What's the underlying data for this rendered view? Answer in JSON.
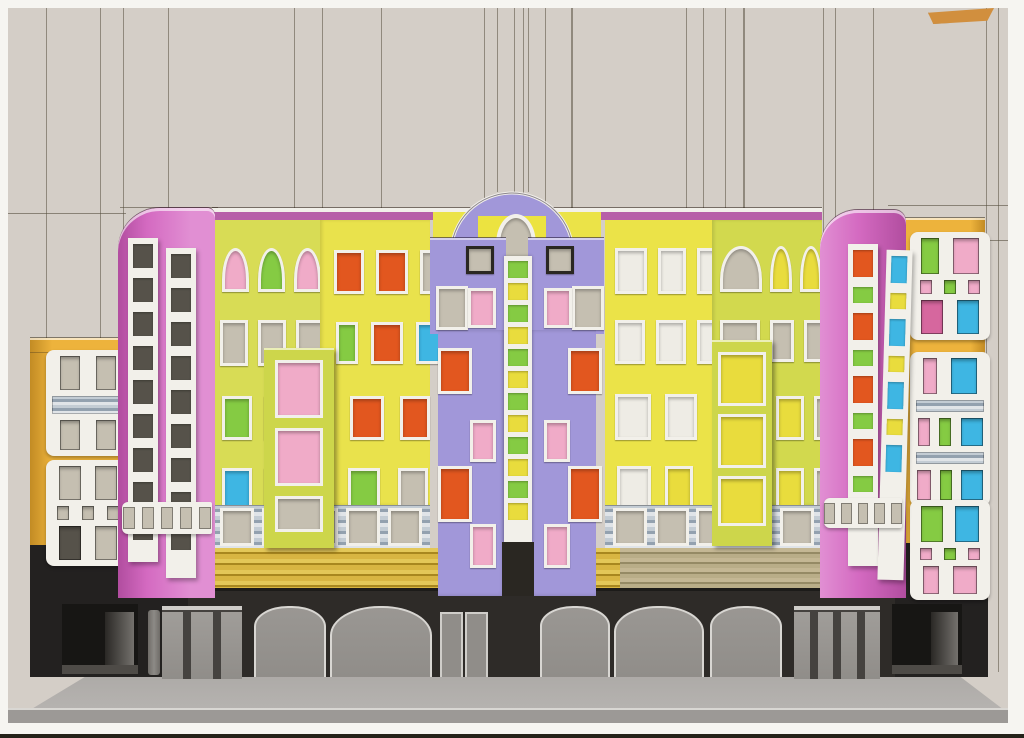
{
  "palette": {
    "cardboard": "#d4cec7",
    "bgline": "#57503f",
    "printWhite": "#f6f5f1",
    "printDark": "#242219",
    "street": "#adaaa7",
    "streetFace": "#9c9996",
    "streetHl": "#d9d7d3",
    "ground": "#2e2b28",
    "groundLip": "#1c1b19",
    "doorGray": "#908d89",
    "doorDark": "#45423f",
    "interior": "#171614",
    "interiorWall": "#74716d",
    "pillar": "#8d8a86",
    "lintel": "#cfcdc9",
    "orangeWing": "#edb33c",
    "wingShade": "#c28b24",
    "wingBase": "#232120",
    "whiteFrame": "#f2f0ea",
    "darkFrame": "#2a2722",
    "paneTan": "#c5bfb1",
    "paneDark": "#56524a",
    "paneWhite": "#eeece5",
    "paneOrange": "#e2571f",
    "paneBlue": "#3eb6e3",
    "paneGreen": "#85cb43",
    "panePink": "#f0abc8",
    "paneMagenta": "#d6679e",
    "paneYellow": "#e9dc3d",
    "pinkTower": "#d46ac1",
    "pinkTowerLight": "#e18fd3",
    "pinkTowerDark": "#b14d9f",
    "magentaTrim": "#b75fa8",
    "lavender": "#a197d9",
    "archYellow": "#ece340",
    "lime1": "#d8dc55",
    "yellow1": "#e9e24c",
    "yellow2": "#ebe348",
    "lime2": "#d2d94e",
    "limeBay": "#cdd64b",
    "mezzA": "#c3ccd4",
    "mezzB": "#93a1af",
    "mezzC": "#e0e4e8",
    "gold": "#d8b542",
    "goldDark": "#a8871f",
    "khaki": "#b9ad88",
    "khakiDark": "#958a65",
    "orangeMark": "#d18f3e"
  },
  "background": {
    "vertical_lines": [
      {
        "x": 46
      },
      {
        "x": 100
      },
      {
        "x": 123
      },
      {
        "x": 168
      },
      {
        "x": 294
      },
      {
        "x": 322
      },
      {
        "x": 381
      },
      {
        "x": 484
      },
      {
        "x": 497,
        "y2": 192
      },
      {
        "x": 514
      },
      {
        "x": 523
      },
      {
        "x": 528,
        "y2": 192
      },
      {
        "x": 545
      },
      {
        "x": 571,
        "w": 2
      },
      {
        "x": 686
      },
      {
        "x": 703
      },
      {
        "x": 725
      },
      {
        "x": 743,
        "w": 2
      },
      {
        "x": 823
      },
      {
        "x": 835
      },
      {
        "x": 873
      },
      {
        "x": 986
      },
      {
        "x": 998
      }
    ],
    "horizontal_lines": [
      {
        "y": 213,
        "x1": 8,
        "x2": 126
      },
      {
        "y": 207,
        "x1": 120,
        "x2": 218
      },
      {
        "y": 205,
        "x1": 888,
        "x2": 1008
      },
      {
        "y": 240,
        "x1": 975,
        "x2": 1008
      }
    ]
  },
  "ground_floor": {
    "arched_doors": [
      {
        "x": 254,
        "w": 68
      },
      {
        "x": 330,
        "w": 98
      },
      {
        "x": 540,
        "w": 66
      },
      {
        "x": 614,
        "w": 86
      },
      {
        "x": 710,
        "w": 68
      }
    ],
    "rect_doors": [
      {
        "x": 440,
        "w": 19
      },
      {
        "x": 465,
        "w": 19
      }
    ],
    "storefronts": [
      {
        "x": 162,
        "w": 80,
        "panels": [
          "g",
          "d",
          "g",
          "d",
          "g"
        ]
      },
      {
        "x": 794,
        "w": 86,
        "panels": [
          "g",
          "d",
          "g",
          "d",
          "g",
          "d",
          "g"
        ]
      }
    ],
    "passages": [
      {
        "x": 62,
        "w": 76
      },
      {
        "x": 892,
        "w": 70
      }
    ]
  },
  "wings": {
    "left": {
      "x": 46,
      "w": 72,
      "groups": [
        {
          "y": 350,
          "rows": [
            {
              "h": 34,
              "wins": [
                {
                  "c": "tan",
                  "w": 20
                },
                {
                  "c": "tan",
                  "w": 20
                }
              ]
            },
            {
              "h": 18,
              "band": true
            },
            {
              "h": 30,
              "wins": [
                {
                  "c": "tan",
                  "w": 20
                },
                {
                  "c": "tan",
                  "w": 20
                }
              ]
            }
          ]
        },
        {
          "y": 460,
          "rows": [
            {
              "h": 34,
              "wins": [
                {
                  "c": "tan",
                  "w": 22
                },
                {
                  "c": "tan",
                  "w": 22
                }
              ]
            },
            {
              "h": 14,
              "wins": [
                {
                  "c": "tan",
                  "w": 12
                },
                {
                  "c": "tan",
                  "w": 12
                },
                {
                  "c": "tan",
                  "w": 12
                }
              ]
            },
            {
              "h": 34,
              "wins": [
                {
                  "c": "dark",
                  "w": 22
                },
                {
                  "c": "tan",
                  "w": 22
                }
              ]
            }
          ]
        }
      ]
    },
    "right": {
      "x": 910,
      "w": 68,
      "groups": [
        {
          "y": 232,
          "rows": [
            {
              "h": 36,
              "wins": [
                {
                  "c": "green",
                  "w": 18
                },
                {
                  "c": "pink",
                  "w": 26
                }
              ]
            },
            {
              "h": 14,
              "wins": [
                {
                  "c": "pink",
                  "w": 12
                },
                {
                  "c": "green",
                  "w": 12
                },
                {
                  "c": "pink",
                  "w": 12
                }
              ]
            },
            {
              "h": 34,
              "wins": [
                {
                  "c": "magenta",
                  "w": 22
                },
                {
                  "c": "blue",
                  "w": 22
                }
              ]
            }
          ]
        },
        {
          "y": 352,
          "rows": [
            {
              "h": 36,
              "wins": [
                {
                  "c": "pink",
                  "w": 14
                },
                {
                  "c": "blue",
                  "w": 26
                }
              ]
            },
            {
              "h": 12,
              "band": true
            },
            {
              "h": 28,
              "wins": [
                {
                  "c": "pink",
                  "w": 12
                },
                {
                  "c": "green",
                  "w": 12
                },
                {
                  "c": "blue",
                  "w": 22
                }
              ]
            },
            {
              "h": 12,
              "band": true
            },
            {
              "h": 30,
              "wins": [
                {
                  "c": "pink",
                  "w": 14
                },
                {
                  "c": "green",
                  "w": 12
                },
                {
                  "c": "blue",
                  "w": 22
                }
              ]
            }
          ]
        },
        {
          "y": 500,
          "rows": [
            {
              "h": 36,
              "wins": [
                {
                  "c": "green",
                  "w": 22
                },
                {
                  "c": "blue",
                  "w": 24
                }
              ]
            },
            {
              "h": 12,
              "wins": [
                {
                  "c": "pink",
                  "w": 12
                },
                {
                  "c": "green",
                  "w": 12
                },
                {
                  "c": "pink",
                  "w": 12
                }
              ]
            },
            {
              "h": 28,
              "wins": [
                {
                  "c": "pink",
                  "w": 16
                },
                {
                  "c": "pink",
                  "w": 24
                }
              ]
            }
          ]
        }
      ]
    }
  },
  "towers": {
    "left": {
      "stripA": {
        "rungs": [
          "dark",
          "dark",
          "dark",
          "dark",
          "dark",
          "dark",
          "dark",
          "dark",
          "dark"
        ]
      },
      "stripB": {
        "rungs": [
          "dark",
          "dark",
          "dark",
          "dark",
          "dark",
          "dark",
          "dark",
          "dark",
          "dark"
        ]
      },
      "band_panes": 5
    },
    "right": {
      "stripA": {
        "rungs": [
          "orange",
          "green",
          "orange",
          "green",
          "orange",
          "green",
          "orange",
          "green"
        ]
      },
      "stripB": {
        "rungs": [
          "blue",
          "yellow",
          "blue",
          "yellow",
          "blue",
          "yellow",
          "blue"
        ]
      },
      "band_panes": 5
    }
  },
  "facade": {
    "panels": [
      {
        "id": "p1",
        "rows": [
          {
            "y": 28,
            "h": 44,
            "pad": 10,
            "gap": 9,
            "arch": true,
            "wins": [
              {
                "c": "pink",
                "w": 21
              },
              {
                "c": "green",
                "w": 21
              },
              {
                "c": "pink",
                "w": 21
              }
            ]
          },
          {
            "y": 100,
            "h": 46,
            "pad": 8,
            "gap": 10,
            "wins": [
              {
                "c": "tan",
                "w": 22
              },
              {
                "c": "tan",
                "w": 22
              },
              {
                "c": "tan",
                "w": 24
              }
            ]
          },
          {
            "y": 176,
            "h": 44,
            "pad": 10,
            "gap": 12,
            "wins": [
              {
                "c": "green",
                "w": 24
              },
              {
                "c": "orange",
                "w": 40
              }
            ]
          },
          {
            "y": 248,
            "h": 44,
            "pad": 10,
            "gap": 12,
            "wins": [
              {
                "c": "blue",
                "w": 24
              },
              {
                "c": "tan",
                "w": 34
              }
            ]
          }
        ]
      },
      {
        "id": "p2",
        "rows": [
          {
            "y": 30,
            "h": 44,
            "pad": 14,
            "gap": 12,
            "wins": [
              {
                "c": "orange",
                "w": 24
              },
              {
                "c": "orange",
                "w": 26
              },
              {
                "c": "tan",
                "w": 18
              }
            ]
          },
          {
            "y": 102,
            "h": 42,
            "pad": 16,
            "gap": 13,
            "wins": [
              {
                "c": "green",
                "w": 16
              },
              {
                "c": "orange",
                "w": 26
              },
              {
                "c": "blue",
                "w": 24
              }
            ]
          },
          {
            "y": 176,
            "h": 44,
            "pad": 30,
            "gap": 16,
            "wins": [
              {
                "c": "orange",
                "w": 28
              },
              {
                "c": "orange",
                "w": 24
              }
            ]
          },
          {
            "y": 248,
            "h": 42,
            "pad": 28,
            "gap": 18,
            "wins": [
              {
                "c": "green",
                "w": 26
              },
              {
                "c": "tan",
                "w": 24
              }
            ]
          }
        ]
      },
      {
        "id": "p4",
        "rows": [
          {
            "y": 28,
            "h": 46,
            "pad": 10,
            "gap": 11,
            "wins": [
              {
                "c": "white",
                "w": 26
              },
              {
                "c": "white",
                "w": 22
              },
              {
                "c": "white",
                "w": 18
              }
            ]
          },
          {
            "y": 100,
            "h": 44,
            "pad": 10,
            "gap": 11,
            "wins": [
              {
                "c": "white",
                "w": 24
              },
              {
                "c": "white",
                "w": 24
              },
              {
                "c": "white",
                "w": 16
              }
            ]
          },
          {
            "y": 174,
            "h": 46,
            "pad": 10,
            "gap": 14,
            "wins": [
              {
                "c": "white",
                "w": 30
              },
              {
                "c": "white",
                "w": 26
              }
            ]
          },
          {
            "y": 246,
            "h": 44,
            "pad": 12,
            "gap": 14,
            "wins": [
              {
                "c": "white",
                "w": 28
              },
              {
                "c": "yellow",
                "w": 22
              }
            ]
          }
        ]
      },
      {
        "id": "p5",
        "rows": [
          {
            "y": 26,
            "h": 46,
            "pad": 8,
            "gap": 8,
            "arch": true,
            "wins": [
              {
                "c": "tan",
                "w": 36
              },
              {
                "c": "yellow",
                "w": 16
              },
              {
                "c": "yellow",
                "w": 16
              },
              {
                "c": "yellow",
                "w": 16
              }
            ]
          },
          {
            "y": 100,
            "h": 42,
            "pad": 8,
            "gap": 10,
            "wins": [
              {
                "c": "tan",
                "w": 34
              },
              {
                "c": "tan",
                "w": 18
              },
              {
                "c": "tan",
                "w": 18
              }
            ]
          },
          {
            "y": 176,
            "h": 44,
            "pad": 64,
            "gap": 10,
            "wins": [
              {
                "c": "yellow",
                "w": 22
              },
              {
                "c": "tan",
                "w": 16
              }
            ]
          },
          {
            "y": 248,
            "h": 42,
            "pad": 64,
            "gap": 10,
            "wins": [
              {
                "c": "yellow",
                "w": 22
              },
              {
                "c": "tan",
                "w": 16
              }
            ]
          }
        ]
      }
    ],
    "balconies": [
      {
        "x": 264,
        "y": 348,
        "w": 70,
        "h": 200,
        "wins": [
          {
            "c": "pink",
            "y": 12,
            "h": 52
          },
          {
            "c": "pink",
            "y": 80,
            "h": 52
          },
          {
            "c": "tan",
            "y": 148,
            "h": 30
          }
        ]
      },
      {
        "x": 712,
        "y": 340,
        "w": 60,
        "h": 206,
        "wins": [
          {
            "c": "yellow",
            "y": 12,
            "h": 48
          },
          {
            "c": "yellow",
            "y": 74,
            "h": 48
          },
          {
            "c": "yellow",
            "y": 136,
            "h": 44
          }
        ]
      }
    ]
  },
  "center": {
    "ladder_rungs": [
      "green",
      "yellow",
      "green",
      "yellow",
      "green",
      "yellow",
      "green",
      "yellow",
      "green",
      "yellow",
      "green",
      "yellow"
    ],
    "pylon_windows": [
      {
        "x": 466,
        "y": 246,
        "w": 22,
        "h": 22,
        "c": "tan",
        "frame": "dark"
      },
      {
        "x": 436,
        "y": 286,
        "w": 26,
        "h": 38,
        "c": "tan"
      },
      {
        "x": 468,
        "y": 288,
        "w": 22,
        "h": 34,
        "c": "pink"
      },
      {
        "x": 438,
        "y": 348,
        "w": 28,
        "h": 40,
        "c": "orange"
      },
      {
        "x": 470,
        "y": 420,
        "w": 20,
        "h": 36,
        "c": "pink"
      },
      {
        "x": 438,
        "y": 466,
        "w": 28,
        "h": 50,
        "c": "orange"
      },
      {
        "x": 470,
        "y": 524,
        "w": 20,
        "h": 38,
        "c": "pink"
      },
      {
        "x": 546,
        "y": 246,
        "w": 22,
        "h": 22,
        "c": "tan",
        "frame": "dark"
      },
      {
        "x": 572,
        "y": 286,
        "w": 26,
        "h": 38,
        "c": "tan"
      },
      {
        "x": 544,
        "y": 288,
        "w": 22,
        "h": 34,
        "c": "pink"
      },
      {
        "x": 568,
        "y": 348,
        "w": 28,
        "h": 40,
        "c": "orange"
      },
      {
        "x": 544,
        "y": 420,
        "w": 20,
        "h": 36,
        "c": "pink"
      },
      {
        "x": 568,
        "y": 466,
        "w": 28,
        "h": 50,
        "c": "orange"
      },
      {
        "x": 544,
        "y": 524,
        "w": 20,
        "h": 38,
        "c": "pink"
      }
    ]
  },
  "mezzanine": {
    "left_windows": 5,
    "right_windows": 5
  }
}
